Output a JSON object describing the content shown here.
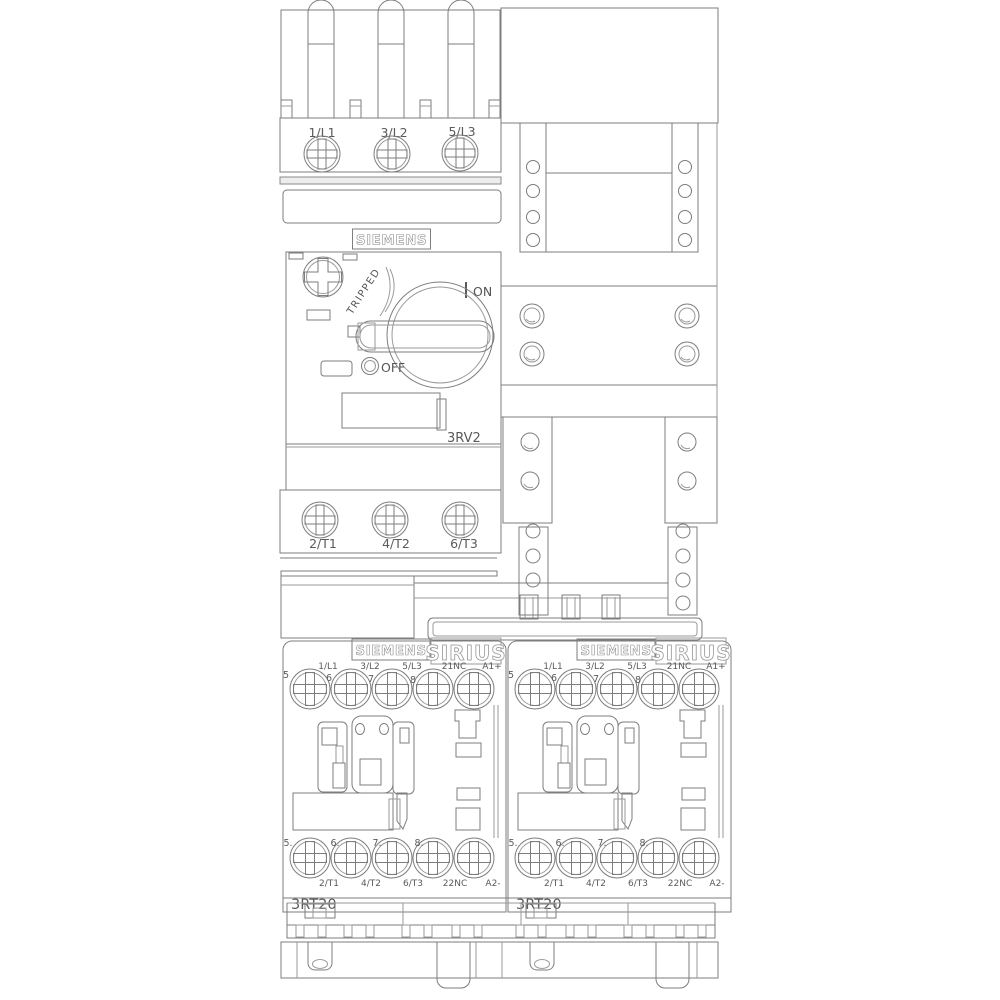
{
  "drawing_title": "Siemens motor starter line drawing",
  "breaker": {
    "brand": "SIEMENS",
    "model": "3RV2",
    "tripped_label": "TRIPPED",
    "on_label": "ON",
    "on_mark": "I",
    "off_label": "OFF",
    "off_mark": "O",
    "line_terminals": [
      "1/L1",
      "3/L2",
      "5/L3"
    ],
    "load_terminals": [
      "2/T1",
      "4/T2",
      "6/T3"
    ]
  },
  "contactor_left": {
    "brand": "SIEMENS",
    "series": "SIRIUS",
    "model": "3RT20",
    "top_terminals": [
      "1/L1",
      "3/L2",
      "5/L3",
      "21NC",
      "A1+"
    ],
    "bottom_terminals": [
      "2/T1",
      "4/T2",
      "6/T3",
      "22NC",
      "A2-"
    ],
    "top_position_markers": [
      "5",
      "6",
      "7",
      "8"
    ],
    "bottom_position_markers": [
      "5.",
      "6.",
      "7.",
      "8."
    ]
  },
  "contactor_right": {
    "brand": "SIEMENS",
    "series": "SIRIUS",
    "model": "3RT20",
    "top_terminals": [
      "1/L1",
      "3/L2",
      "5/L3",
      "21NC",
      "A1+"
    ],
    "bottom_terminals": [
      "2/T1",
      "4/T2",
      "6/T3",
      "22NC",
      "A2-"
    ],
    "top_position_markers": [
      "5",
      "6",
      "7",
      "8"
    ],
    "bottom_position_markers": [
      "5.",
      "6.",
      "7.",
      "8."
    ]
  },
  "colors": {
    "line": "#7d7d7d",
    "text": "#5a5a5a",
    "background": "#ffffff"
  }
}
